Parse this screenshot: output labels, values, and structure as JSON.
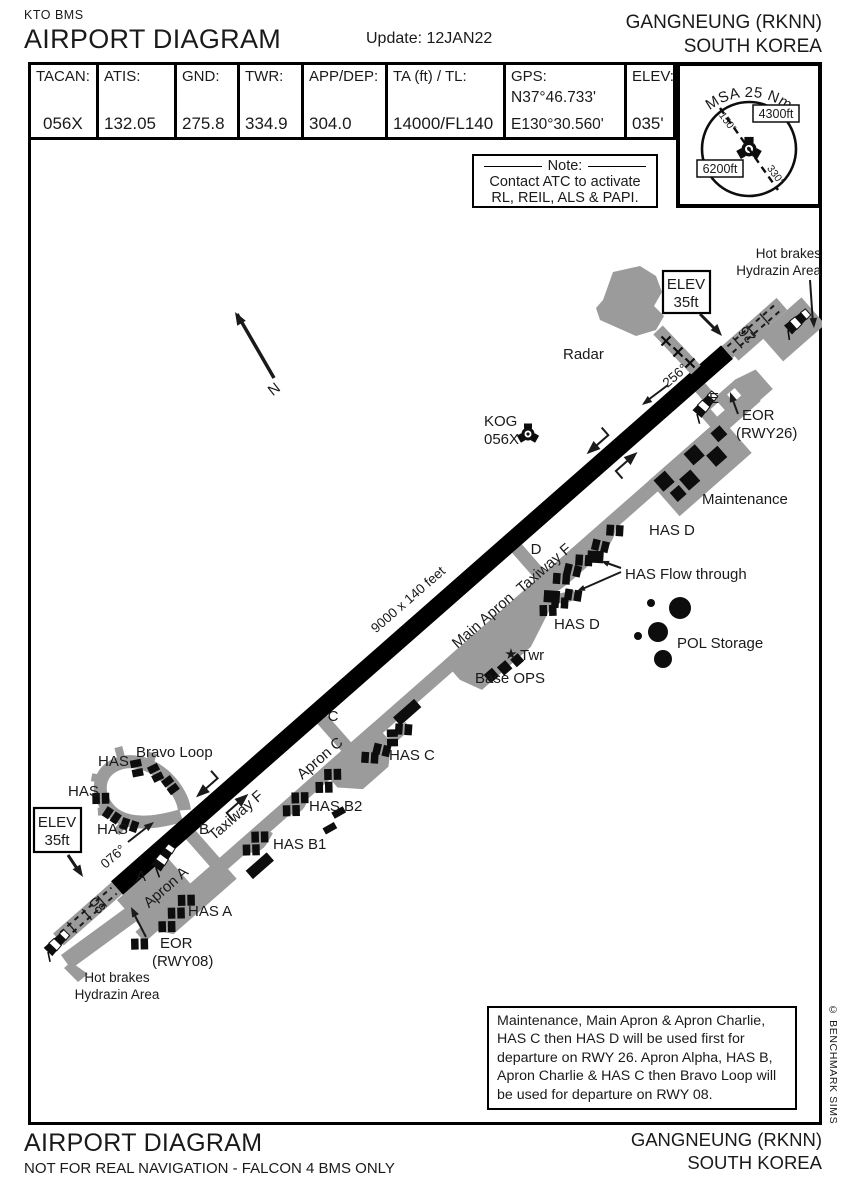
{
  "header": {
    "program": "KTO BMS",
    "title": "AIRPORT DIAGRAM",
    "update": "Update: 12JAN22",
    "airport": "GANGNEUNG (RKNN)",
    "country": "SOUTH KOREA"
  },
  "info_table": {
    "cells": [
      {
        "label": "TACAN:",
        "value": "056X"
      },
      {
        "label": "ATIS:",
        "value": "132.05"
      },
      {
        "label": "GND:",
        "value": "275.8"
      },
      {
        "label": "TWR:",
        "value": "334.9"
      },
      {
        "label": "APP/DEP:",
        "value": "304.0"
      },
      {
        "label": "TA (ft) / TL:",
        "value": "14000/FL140"
      },
      {
        "label": "GPS:",
        "value": "N37°46.733'",
        "value2": "E130°30.560'"
      },
      {
        "label": "ELEV:",
        "value": "035'"
      }
    ]
  },
  "msa": {
    "title": "MSA 25 Nm",
    "alt_high": "4300ft",
    "alt_low": "6200ft",
    "radial_1": "150°",
    "radial_2": "330°"
  },
  "note_box": {
    "title": "Note:",
    "line1": "Contact ATC to activate",
    "line2": "RL, REIL, ALS & PAPI."
  },
  "diagram": {
    "north_label": "N",
    "radar": "Radar",
    "navaid": {
      "name": "KOG",
      "channel": "056X"
    },
    "hot_brakes": {
      "line1": "Hot brakes",
      "line2": "Hydrazin Area"
    },
    "elev_box": {
      "line1": "ELEV",
      "line2": "35ft"
    },
    "runway": {
      "num_08": "08",
      "num_26": "26",
      "hdg_08": "076°",
      "hdg_26": "256°",
      "size": "9000 x 140 feet"
    },
    "letters": {
      "a": "A",
      "b": "B",
      "c": "C",
      "d": "D",
      "e": "E"
    },
    "taxiway_f": "Taxiway F",
    "eor26": {
      "line1": "EOR",
      "line2": "(RWY26)"
    },
    "eor08": {
      "line1": "EOR",
      "line2": "(RWY08)"
    },
    "maintenance": "Maintenance",
    "has_d": "HAS D",
    "has_flow": "HAS Flow through",
    "pol": "POL Storage",
    "twr_star": "★",
    "twr": "Twr",
    "base_ops": "Base OPS",
    "main_apron": "Main Apron",
    "apron_c": "Apron C",
    "apron_a": "Apron A",
    "has_c": "HAS C",
    "has_b2": "HAS B2",
    "has_b1": "HAS B1",
    "has_a": "HAS A",
    "has": "HAS",
    "bravo_loop": "Bravo Loop",
    "departure_note": "Maintenance, Main Apron & Apron Charlie, HAS C then HAS D will be used first for departure on RWY 26. Apron Alpha, HAS B, Apron Charlie & HAS C then Bravo Loop will be used for departure on RWY 08."
  },
  "footer": {
    "title": "AIRPORT DIAGRAM",
    "disclaimer": "NOT FOR REAL NAVIGATION - FALCON 4 BMS ONLY",
    "airport": "GANGNEUNG (RKNN)",
    "country": "SOUTH KOREA",
    "copyright": "© BENCHMARK SIMS"
  },
  "colors": {
    "pavement": "#9b9b9b",
    "runway": "#000000",
    "ink": "#1a1a1a"
  }
}
